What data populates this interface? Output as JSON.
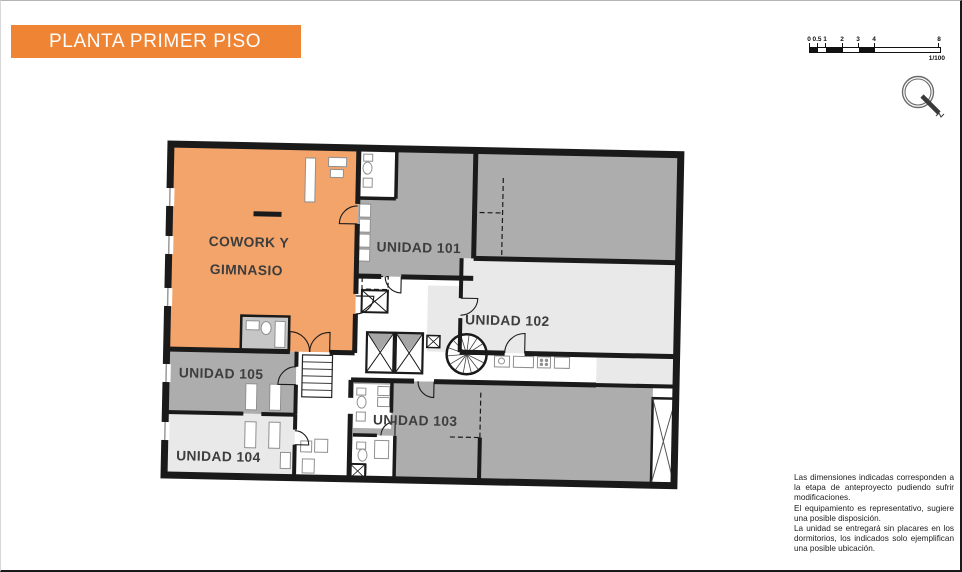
{
  "header": {
    "title": "PLANTA PRIMER PISO",
    "background": "#EE8434"
  },
  "scale_bar": {
    "ticks": [
      "0",
      "0.5",
      "1",
      "2",
      "3",
      "4",
      "8"
    ],
    "ratio_label": "1/100"
  },
  "plan": {
    "rooms": [
      {
        "id": "cowork",
        "label_line1": "COWORK Y",
        "label_line2": "GIMNASIO",
        "color": "#F3A46A"
      },
      {
        "id": "unidad-101",
        "label": "UNIDAD 101",
        "color": "#ADADAD"
      },
      {
        "id": "unidad-102",
        "label": "UNIDAD 102",
        "color": "#E9E9E9"
      },
      {
        "id": "unidad-103",
        "label": "UNIDAD 103",
        "color": "#ADADAD"
      },
      {
        "id": "unidad-104",
        "label": "UNIDAD 104",
        "color": "#E9E9E9"
      },
      {
        "id": "unidad-105",
        "label": "UNIDAD 105",
        "color": "#ADADAD"
      }
    ]
  },
  "disclaimer": {
    "paragraphs": [
      "Las dimensiones indicadas corresponden a la etapa de anteproyecto pudiendo sufrir modificaciones.",
      "El equipamiento es representativo, sugiere una posible disposición.",
      "La unidad se entregará sin placares en los dormitorios, los indicados solo ejemplifican una posible ubicación."
    ]
  }
}
